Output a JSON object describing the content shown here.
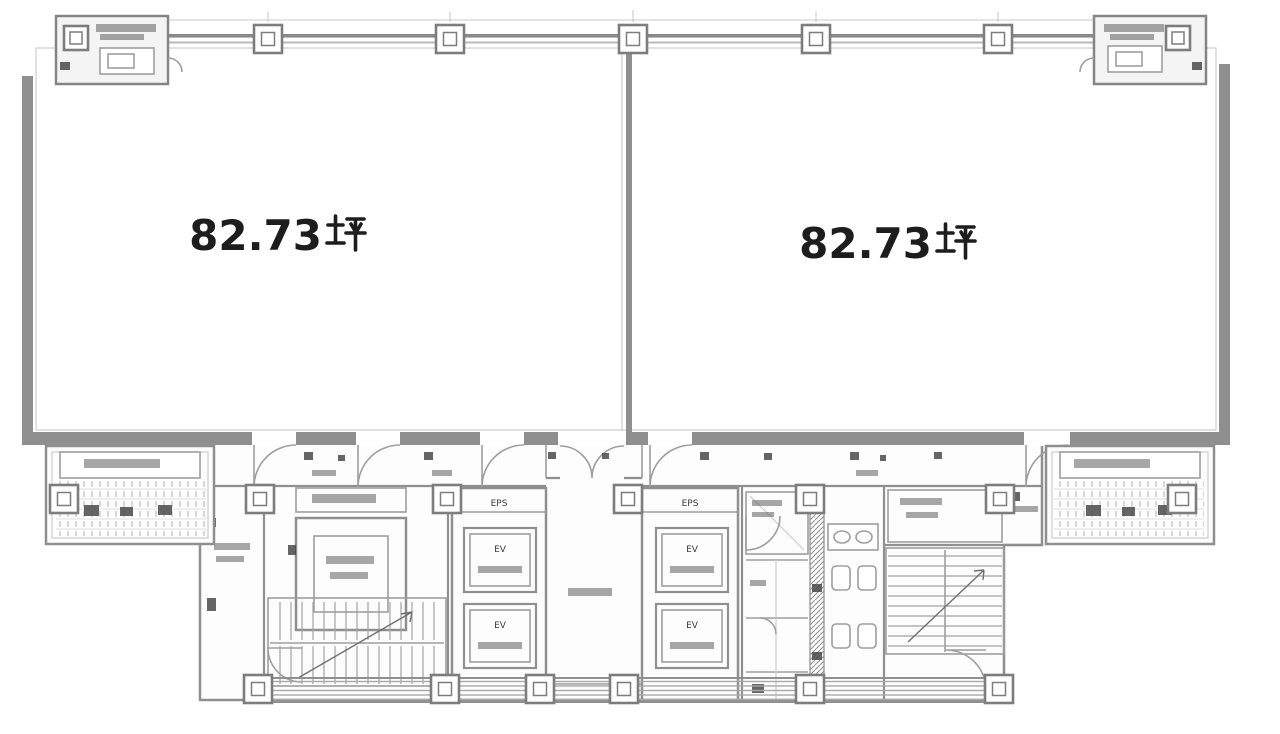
{
  "rooms": [
    {
      "name": "left-office",
      "area_value": "82.73",
      "area_unit": "坪"
    },
    {
      "name": "right-office",
      "area_value": "82.73",
      "area_unit": "坪"
    }
  ],
  "core": {
    "left_elevator_bank_label": "EPS",
    "right_elevator_bank_label": "EPS",
    "elevator_car_label": "EV"
  },
  "colors": {
    "paper": "#ffffff",
    "ink": "#1d1d1d",
    "wall": "#8f8f8f",
    "wall_mid": "#9e9e9e",
    "line_light": "#c8c8c8",
    "smudge": "#4f4f4f",
    "fill_light": "#f4f4f4"
  }
}
